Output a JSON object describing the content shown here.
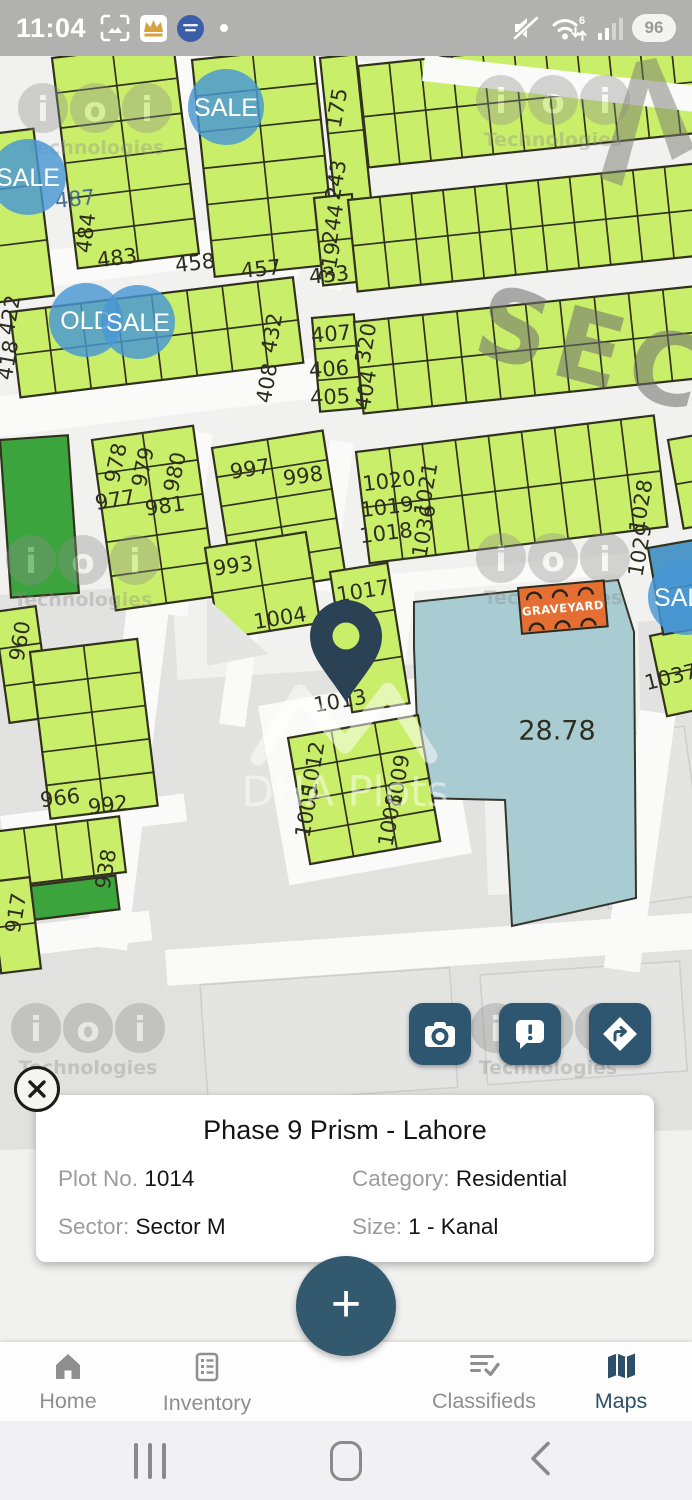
{
  "status_bar": {
    "time": "11:04",
    "battery_percent": "96",
    "wifi_label": "6",
    "left_icons": [
      "screenshot-icon",
      "crown-app-icon",
      "messenger-icon",
      "notification-dot"
    ],
    "right_icons": [
      "mute-icon",
      "wifi6-icon",
      "signal-icon",
      "battery-pill"
    ]
  },
  "map": {
    "colors": {
      "plot_green": "#c9ee69",
      "plot_dark_green": "#3ca43c",
      "plot_blue": "#4e97c9",
      "teal_area": "#a9cbd2",
      "graveyard_orange": "#e56f33",
      "bubble_blue": "#4897d4",
      "stroke": "#31311e"
    },
    "sector_watermark": "SEC",
    "brand_watermark": "DHA Plots",
    "graveyard_label": "GRAVEYARD",
    "watermark_ioi": {
      "letters": [
        "i",
        "o",
        "i"
      ],
      "caption": "Technologies",
      "positions": [
        [
          95,
          108
        ],
        [
          553,
          100
        ],
        [
          83,
          560
        ],
        [
          553,
          558
        ],
        [
          88,
          1028
        ],
        [
          548,
          1028
        ]
      ]
    },
    "bubbles": [
      [
        "SALE",
        226,
        107,
        38
      ],
      [
        "SALE",
        28,
        177,
        38
      ],
      [
        "OLD",
        86,
        320,
        37
      ],
      [
        "SALE",
        138,
        322,
        37
      ],
      [
        "SALE",
        686,
        597,
        38
      ]
    ],
    "blocks": [
      [
        -42,
        138,
        -7,
        76,
        168,
        1,
        3
      ],
      [
        52,
        58,
        -7,
        122,
        212,
        2,
        6
      ],
      [
        192,
        60,
        -6,
        122,
        218,
        2,
        6
      ],
      [
        320,
        58,
        -6,
        36,
        152,
        1,
        2
      ],
      [
        314,
        198,
        -6,
        38,
        88,
        1,
        2
      ],
      [
        640,
        42,
        -6,
        58,
        38,
        2,
        1,
        "#3ca43c"
      ],
      [
        358,
        66,
        -6,
        345,
        102,
        11,
        2
      ],
      [
        348,
        200,
        -6,
        350,
        92,
        11,
        2
      ],
      [
        10,
        312,
        -7,
        285,
        86,
        8,
        2
      ],
      [
        312,
        318,
        -5,
        42,
        94,
        1,
        3
      ],
      [
        354,
        322,
        -6,
        345,
        92,
        10,
        2
      ],
      [
        92,
        440,
        -8,
        102,
        172,
        2,
        5
      ],
      [
        212,
        448,
        -9,
        112,
        148,
        2,
        5
      ],
      [
        205,
        548,
        -9,
        102,
        92,
        2,
        2
      ],
      [
        356,
        452,
        -7,
        300,
        112,
        9,
        2
      ],
      [
        330,
        572,
        -9,
        58,
        142,
        1,
        3
      ],
      [
        650,
        636,
        -12,
        46,
        82,
        1,
        2
      ],
      [
        -6,
        612,
        -8,
        42,
        112,
        1,
        3
      ],
      [
        30,
        652,
        -7,
        108,
        168,
        2,
        5
      ],
      [
        -8,
        832,
        -7,
        128,
        56,
        4,
        1
      ],
      [
        30,
        886,
        -7,
        86,
        34,
        1,
        1,
        "#3ca43c"
      ],
      [
        -10,
        882,
        -7,
        40,
        92,
        1,
        2
      ],
      [
        288,
        738,
        -10,
        132,
        128,
        3,
        4
      ],
      [
        0,
        440,
        -4,
        68,
        158,
        1,
        1,
        "#3ca43c"
      ],
      [
        648,
        548,
        -10,
        48,
        88,
        1,
        2,
        "#4e97c9"
      ],
      [
        668,
        440,
        -10,
        40,
        90,
        1,
        2
      ]
    ],
    "plot_labels": [
      [
        "487",
        75,
        199,
        -6,
        21,
        "#47718c"
      ],
      [
        "484",
        86,
        233,
        -83
      ],
      [
        "483",
        117,
        258,
        -7
      ],
      [
        "458",
        195,
        263,
        -7
      ],
      [
        "457",
        261,
        269,
        -6
      ],
      [
        "433",
        329,
        275,
        -6
      ],
      [
        "175",
        337,
        108,
        -80
      ],
      [
        "243",
        336,
        180,
        -80
      ],
      [
        "244",
        333,
        224,
        -80
      ],
      [
        "319",
        330,
        262,
        -80
      ],
      [
        "422",
        10,
        315,
        -80
      ],
      [
        "418",
        8,
        360,
        -80
      ],
      [
        "432",
        272,
        333,
        -80
      ],
      [
        "408",
        267,
        383,
        -80
      ],
      [
        "407",
        331,
        334,
        -5
      ],
      [
        "406",
        329,
        369,
        -4
      ],
      [
        "405",
        330,
        397,
        -3
      ],
      [
        "320",
        366,
        343,
        -80
      ],
      [
        "404",
        366,
        390,
        -80
      ],
      [
        "978",
        116,
        463,
        -78
      ],
      [
        "979",
        143,
        467,
        -78
      ],
      [
        "980",
        175,
        472,
        -78
      ],
      [
        "977",
        115,
        500,
        -9
      ],
      [
        "981",
        165,
        506,
        -8
      ],
      [
        "997",
        250,
        469,
        -9
      ],
      [
        "998",
        303,
        476,
        -8
      ],
      [
        "993",
        233,
        566,
        -8
      ],
      [
        "1004",
        280,
        618,
        -9
      ],
      [
        "1020",
        389,
        481,
        -7
      ],
      [
        "1019",
        387,
        507,
        -7
      ],
      [
        "1018",
        386,
        533,
        -7
      ],
      [
        "1021",
        426,
        489,
        -80
      ],
      [
        "1036",
        424,
        531,
        -80
      ],
      [
        "1028",
        641,
        506,
        -80
      ],
      [
        "1029",
        640,
        550,
        -80
      ],
      [
        "1017",
        363,
        591,
        -9
      ],
      [
        "1013",
        340,
        701,
        -10
      ],
      [
        "1037",
        671,
        677,
        -14
      ],
      [
        "28.78",
        557,
        731,
        0,
        27
      ],
      [
        "960",
        20,
        641,
        -80
      ],
      [
        "966",
        60,
        798,
        -7
      ],
      [
        "992",
        108,
        805,
        -7
      ],
      [
        "938",
        106,
        869,
        -80
      ],
      [
        "917",
        16,
        913,
        -80
      ],
      [
        "1012",
        313,
        768,
        -80
      ],
      [
        "1005",
        307,
        811,
        -80
      ],
      [
        "1009",
        398,
        781,
        -80
      ],
      [
        "1008",
        390,
        820,
        -80
      ]
    ]
  },
  "action_buttons": [
    {
      "name": "camera"
    },
    {
      "name": "report"
    },
    {
      "name": "directions"
    }
  ],
  "info_card": {
    "title": "Phase 9 Prism - Lahore",
    "fields": [
      {
        "label": "Plot No.",
        "value": "1014"
      },
      {
        "label": "Category:",
        "value": "Residential"
      },
      {
        "label": "Sector:",
        "value": "Sector M"
      },
      {
        "label": "Size:",
        "value": "1 - Kanal"
      }
    ]
  },
  "fab": {
    "label": "+"
  },
  "bottom_nav": {
    "active_color": "#2d5068",
    "items": [
      {
        "label": "Home",
        "icon": "home-icon",
        "active": false
      },
      {
        "label": "Inventory",
        "icon": "inventory-icon",
        "active": false
      },
      {
        "label": "Classifieds",
        "icon": "classifieds-icon",
        "active": false
      },
      {
        "label": "Maps",
        "icon": "maps-icon",
        "active": true
      }
    ]
  },
  "android_nav": {
    "icons": [
      "recents-icon",
      "home-icon",
      "back-icon"
    ]
  }
}
